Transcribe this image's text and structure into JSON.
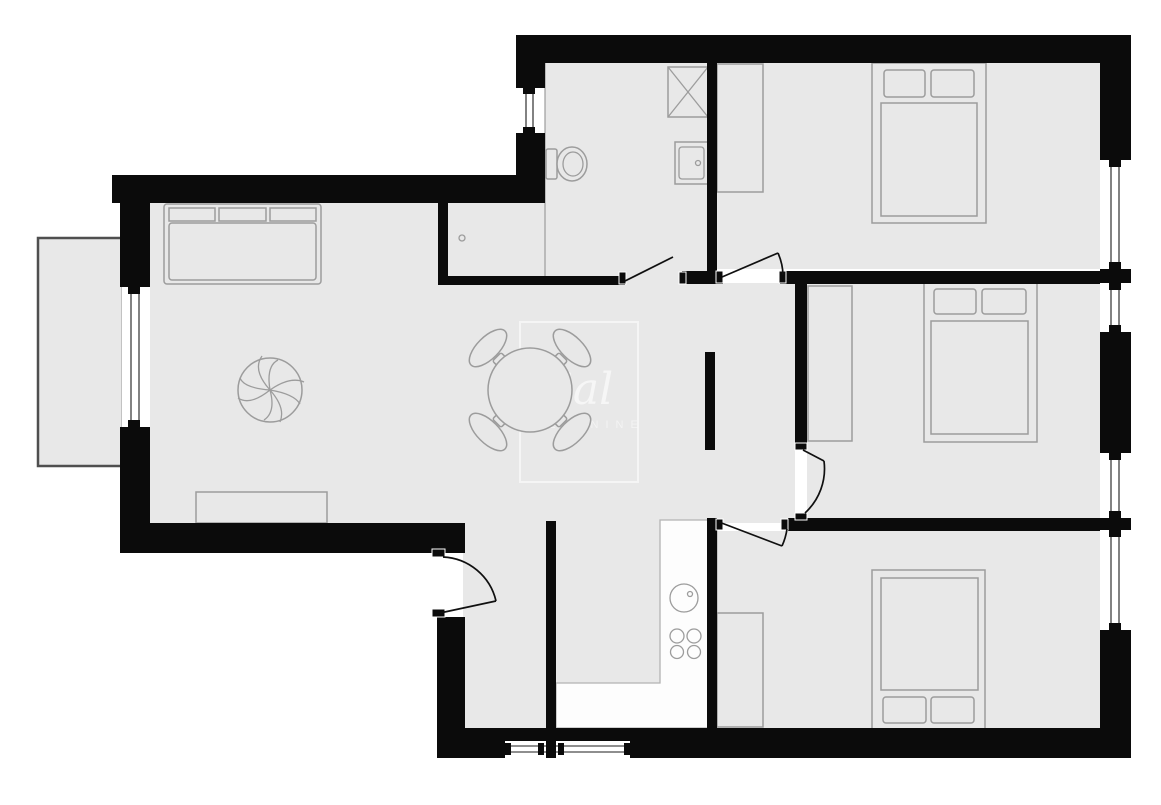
{
  "watermark": {
    "script_text": "Sal",
    "caps_text": "NEXTNINE"
  },
  "colors": {
    "wall": "#0b0b0b",
    "floor": "#e8e8e8",
    "furniture_stroke": "#9c9c9c",
    "counter": "#fdfdfd",
    "balcony_stroke": "#4f4f4f",
    "watermark": "#ffffff"
  },
  "furniture_icons": [
    "sofa-icon",
    "sideboard-icon",
    "plant-icon",
    "dining-table-icon",
    "dining-chair-icon",
    "double-bed-icon",
    "pillow-icon",
    "wardrobe-icon",
    "toilet-icon",
    "shower-icon",
    "bathroom-sink-icon",
    "kitchen-counter-icon",
    "kitchen-sink-icon",
    "stove-burner-icon",
    "balcony-icon",
    "window-icon",
    "door-swing-icon"
  ]
}
